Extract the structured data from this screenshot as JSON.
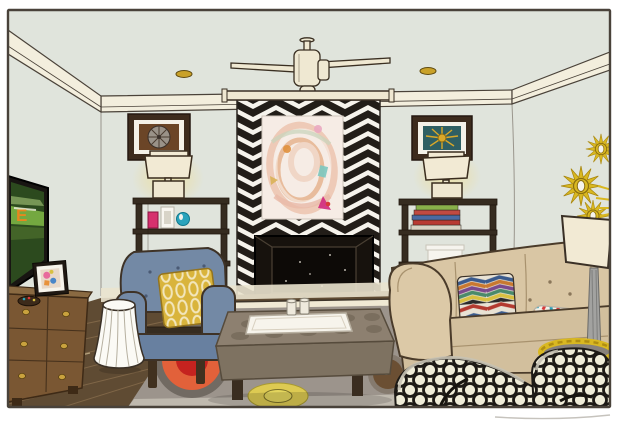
{
  "scene": {
    "description": "Hand-drawn illustration of an eclectic living room with chevron tapestry wall hanging, fireplace, flanking etageres, blue wingback chair, tan tufted sofa and trellis-pattern chair",
    "tv": {
      "screen_label": "E"
    }
  },
  "palette": {
    "wall": "#e0e4dc",
    "molding": "#f3eedd",
    "baseboard": "#eae3ce",
    "floor_wood": "#5f4b33",
    "rug": "#9c948c",
    "rug_edge": "#c3bcb1",
    "rug_red": "#c5231f",
    "rug_orange": "#e2613a",
    "rug_yellow": "#ddca52",
    "rug_brown": "#6b4f33",
    "tapestry_ink": "#221d18",
    "tapestry_ground": "#f6f3ec",
    "painting_base": "#f6ece5",
    "fireplace": "#17120d",
    "hearth": "#f0e9d4",
    "shelf": "#362c20",
    "lamp_shade": "#f2ead4",
    "chair_blue": "#7389a5",
    "pillow_gold": "#d9b43c",
    "stool": "#fbfaf5",
    "ottoman": "#8d8070",
    "sofa": "#d9c6a4",
    "trellis_ground": "#efecd8",
    "trellis_ink": "#1d1a16",
    "basket": "#d9b821",
    "sunburst": "#d9b821",
    "dresser": "#7a5733",
    "tv_frame": "#181512",
    "tv_green": "#7cb344",
    "tv_orange": "#e8871e"
  },
  "pillows": {
    "chevron_stripes": [
      "#b33a30",
      "#e8e2d4",
      "#3a5a8c",
      "#c87830",
      "#7a4a8c",
      "#4a8a6a",
      "#d8c040",
      "#2b2b2b"
    ],
    "confetti_dots": [
      "#d83a3a",
      "#2aa3bc",
      "#e8923c",
      "#3a5a8c",
      "#d8326e",
      "#d8c040"
    ]
  },
  "books": {
    "stack": [
      "#88b04a",
      "#c04a42",
      "#4a6aa2",
      "#b83a32",
      "#d8d2c2"
    ],
    "spines": [
      "#3a4a7a",
      "#c8c4b8",
      "#a83830",
      "#2a3a5a",
      "#c8a878",
      "#e8e4da",
      "#4a6a9a"
    ]
  },
  "shelf_items": {
    "pink_box": "#d6306e",
    "white_frame": "#f8f6f0",
    "teal_disc": "#2aa3bc"
  }
}
